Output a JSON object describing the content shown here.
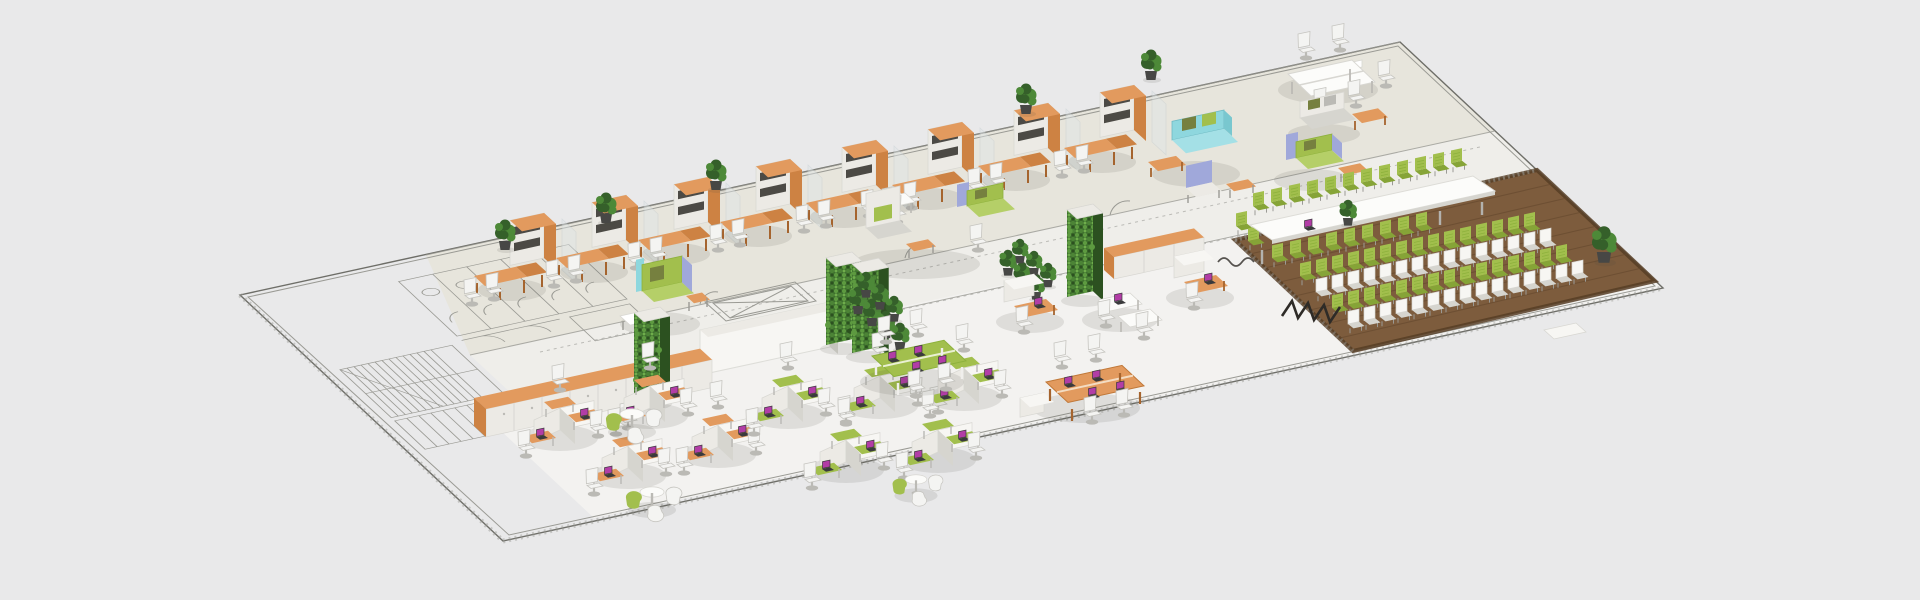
{
  "page": {
    "kind": "isometric-office-floorplan-render",
    "view": "3d-isometric",
    "visible_text": []
  },
  "palette": {
    "bg": "#e9e9ea",
    "floor_upper": "#e7e5dc",
    "floor_corridor": "#efeeea",
    "floor_lower": "#f3f2f0",
    "cad_line": "#9a9a94",
    "wall_line": "#6e6e68",
    "white": "#f7f6f3",
    "white_face": "#eceae5",
    "white_shade": "#d6d5cf",
    "slot_dark": "#4c4a45",
    "orange": "#e29a5e",
    "orange_dark": "#cd8243",
    "orange_deep": "#a5642e",
    "green": "#a2bf4d",
    "green_dark": "#86a437",
    "olive": "#76803f",
    "living_wall": "#3d6f2d",
    "living_wall_hi": "#5d9a40",
    "living_wall_dk": "#2c5120",
    "plant": "#35602a",
    "plant_hi": "#4d8938",
    "pot": "#474745",
    "wood": "#7d5c3d",
    "wood_dark": "#66492e",
    "wood_border": "#563d25",
    "cyan": "#8ed7de",
    "lavender": "#a0a8da",
    "chair_white": "#f4f4f2",
    "chair_frame": "#c6c5c0",
    "leg_gray": "#bbbab5",
    "laptop_screen": "#b23da6",
    "laptop_base": "#3a3a3c",
    "table_white": "#fcfcfa",
    "cable_black": "#2e2b27",
    "shadow": "rgba(70,70,65,0.12)"
  },
  "scene": {
    "areas": [
      {
        "name": "cad-floorplan-wing",
        "description_kind": "unfurnished 2D CAD drawing: stairwell, WC stalls, door swings"
      },
      {
        "name": "executive-office-row",
        "workstations": 9,
        "desk_color": "orange",
        "chairs": "white-task"
      },
      {
        "name": "lounge-zone",
        "sofas": 6,
        "sofa_colors": [
          "cyan",
          "green",
          "gray-white"
        ],
        "accent": "lavender"
      },
      {
        "name": "team-bench-top-right",
        "seats": 5
      },
      {
        "name": "corridor",
        "features": [
          "elevator-shaft-cad",
          "living-walls",
          "white-partition-wall"
        ]
      },
      {
        "name": "open-plan-hex-pods",
        "pods": 9,
        "accents": [
          "orange",
          "green"
        ],
        "laptops_visible": true
      },
      {
        "name": "bench-desks",
        "green_bench_seats": 4,
        "orange_bench_seats": 4
      },
      {
        "name": "round-lounge-groups",
        "groups": 3
      },
      {
        "name": "conference-room",
        "floor": "dark-wood-planks",
        "table_seats": 23,
        "audience_rows": 4,
        "audience_chairs_per_row": 15,
        "audience_colors": [
          "green",
          "white"
        ],
        "cable": "black-zigzag"
      }
    ],
    "counts": {
      "living_wall_columns": 4,
      "potted_plants": 21,
      "storage_cabinet_runs": 3,
      "laptops_with_purple_screens": 18
    }
  }
}
